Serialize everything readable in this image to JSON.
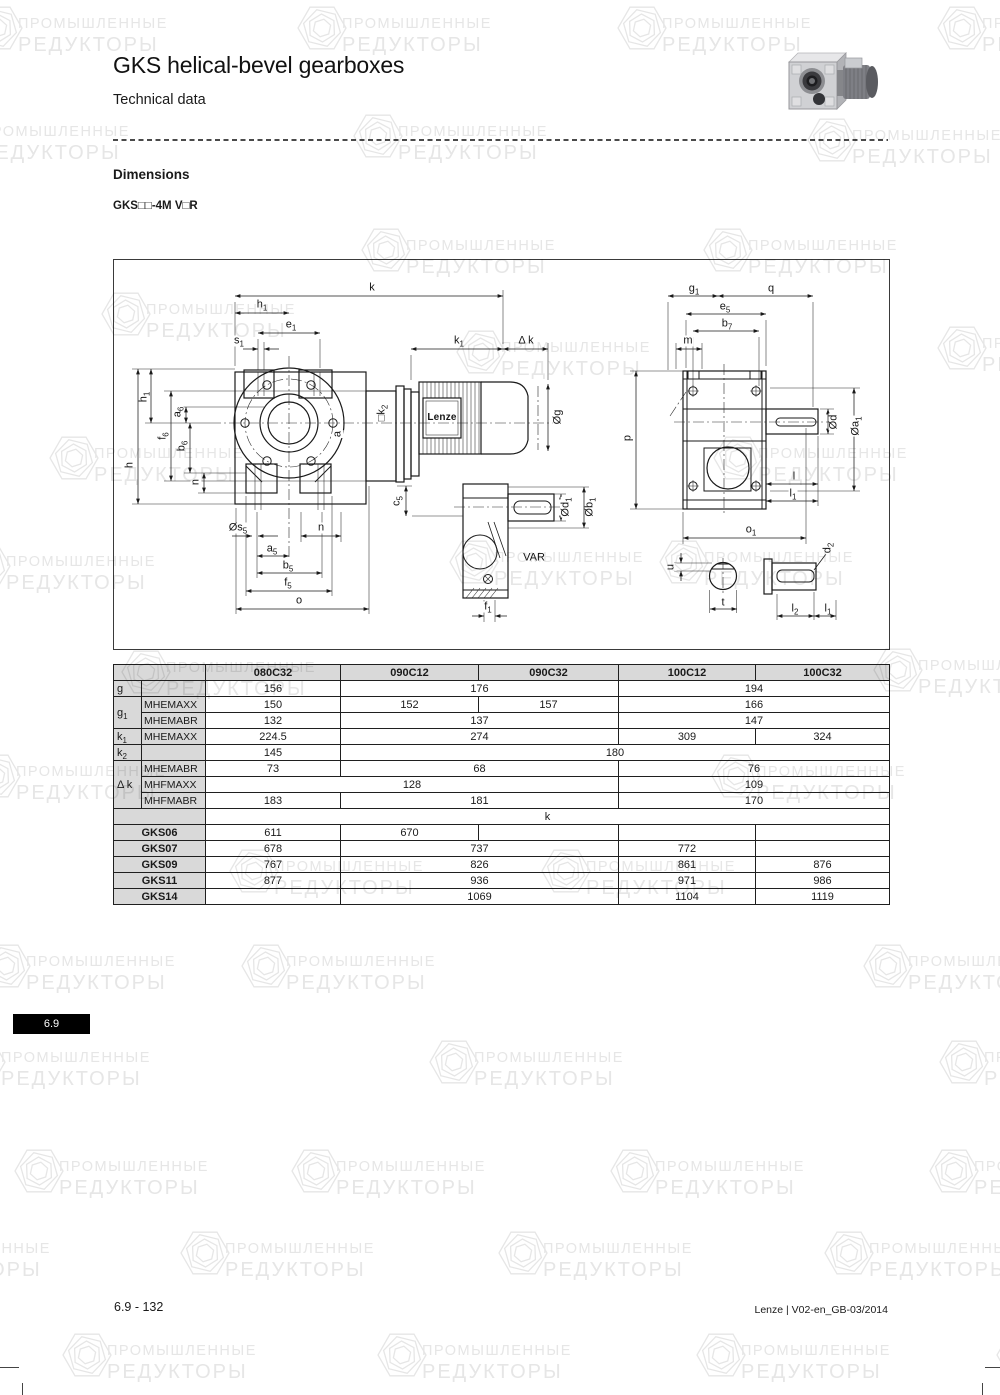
{
  "page": {
    "title": "GKS helical-bevel gearboxes",
    "subtitle": "Technical data",
    "section_heading": "Dimensions",
    "model_label": "GKS□□-4M V□R",
    "tab_label": "6.9",
    "footer_left": "6.9 - 132",
    "footer_right": "Lenze | V02-en_GB-03/2014"
  },
  "watermark": {
    "line1": "ПРОМЫШЛЕННЫЕ",
    "line2": "РЕДУКТОРЫ",
    "color": "#e6e6e6",
    "positions": [
      {
        "x": -28,
        "y": 0
      },
      {
        "x": 296,
        "y": 0
      },
      {
        "x": 616,
        "y": 0
      },
      {
        "x": 936,
        "y": 0
      },
      {
        "x": -66,
        "y": 108
      },
      {
        "x": 352,
        "y": 108
      },
      {
        "x": 806,
        "y": 112
      },
      {
        "x": 100,
        "y": 286
      },
      {
        "x": 360,
        "y": 222
      },
      {
        "x": 702,
        "y": 222
      },
      {
        "x": 455,
        "y": 324
      },
      {
        "x": 936,
        "y": 320
      },
      {
        "x": 48,
        "y": 430
      },
      {
        "x": 712,
        "y": 430
      },
      {
        "x": -40,
        "y": 538
      },
      {
        "x": 448,
        "y": 534
      },
      {
        "x": 658,
        "y": 534
      },
      {
        "x": 120,
        "y": 644
      },
      {
        "x": 872,
        "y": 642
      },
      {
        "x": -30,
        "y": 748
      },
      {
        "x": 710,
        "y": 748
      },
      {
        "x": 228,
        "y": 843
      },
      {
        "x": 540,
        "y": 843
      },
      {
        "x": -20,
        "y": 938
      },
      {
        "x": 240,
        "y": 938
      },
      {
        "x": 862,
        "y": 938
      },
      {
        "x": -45,
        "y": 1034
      },
      {
        "x": 428,
        "y": 1034
      },
      {
        "x": 938,
        "y": 1034
      },
      {
        "x": 13,
        "y": 1143
      },
      {
        "x": 290,
        "y": 1143
      },
      {
        "x": 609,
        "y": 1143
      },
      {
        "x": 928,
        "y": 1143
      },
      {
        "x": -145,
        "y": 1225
      },
      {
        "x": 179,
        "y": 1225
      },
      {
        "x": 497,
        "y": 1225
      },
      {
        "x": 823,
        "y": 1225
      },
      {
        "x": 61,
        "y": 1327
      },
      {
        "x": 376,
        "y": 1327
      },
      {
        "x": 695,
        "y": 1327
      },
      {
        "x": 995,
        "y": 1327
      }
    ]
  },
  "diagram": {
    "motor_brand": "Lenze",
    "variant_label": "VAR",
    "labels": [
      {
        "t": "k",
        "x": 258,
        "y": 28
      },
      {
        "t": "h_1",
        "x": 148,
        "y": 45
      },
      {
        "t": "e_1",
        "x": 177,
        "y": 65
      },
      {
        "t": "s_1",
        "x": 125,
        "y": 81
      },
      {
        "t": "k_1",
        "x": 345,
        "y": 81
      },
      {
        "t": "Δ k",
        "x": 412,
        "y": 81
      },
      {
        "t": "Øg",
        "x": 444,
        "y": 157,
        "r": 1
      },
      {
        "t": "h_1",
        "x": 30,
        "y": 137,
        "r": 1
      },
      {
        "t": "a_6",
        "x": 64,
        "y": 152,
        "r": 1
      },
      {
        "t": "f_6",
        "x": 49,
        "y": 176,
        "r": 1
      },
      {
        "t": "b_6",
        "x": 68,
        "y": 186,
        "r": 1
      },
      {
        "t": "h",
        "x": 16,
        "y": 205,
        "r": 1
      },
      {
        "t": "n",
        "x": 82,
        "y": 222,
        "r": 1
      },
      {
        "t": "a",
        "x": 224,
        "y": 174,
        "r": 1
      },
      {
        "t": "□k_2",
        "x": 268,
        "y": 153,
        "r": 1
      },
      {
        "t": "Øs_5",
        "x": 124,
        "y": 268
      },
      {
        "t": "n",
        "x": 207,
        "y": 268
      },
      {
        "t": "a_5",
        "x": 158,
        "y": 289
      },
      {
        "t": "b_5",
        "x": 174,
        "y": 306
      },
      {
        "t": "f_5",
        "x": 174,
        "y": 323
      },
      {
        "t": "o",
        "x": 185,
        "y": 341
      },
      {
        "t": "c_5",
        "x": 283,
        "y": 241,
        "r": 1
      },
      {
        "t": "Ød_1",
        "x": 452,
        "y": 247,
        "r": 1
      },
      {
        "t": "Øb_1",
        "x": 476,
        "y": 247,
        "r": 1
      },
      {
        "t": "VAR",
        "x": 420,
        "y": 298
      },
      {
        "t": "f_1",
        "x": 374,
        "y": 347
      },
      {
        "t": "Lenze",
        "x": 328,
        "y": 158,
        "cls": "lenze"
      },
      {
        "t": "g_1",
        "x": 580,
        "y": 29
      },
      {
        "t": "q",
        "x": 657,
        "y": 29
      },
      {
        "t": "e_5",
        "x": 611,
        "y": 47
      },
      {
        "t": "b_7",
        "x": 613,
        "y": 64
      },
      {
        "t": "m",
        "x": 574,
        "y": 81
      },
      {
        "t": "p",
        "x": 514,
        "y": 178,
        "r": 1
      },
      {
        "t": "Ød",
        "x": 720,
        "y": 162,
        "r": 1
      },
      {
        "t": "Øa_1",
        "x": 742,
        "y": 166,
        "r": 1
      },
      {
        "t": "l",
        "x": 680,
        "y": 217
      },
      {
        "t": "l_1",
        "x": 679,
        "y": 234
      },
      {
        "t": "o_1",
        "x": 637,
        "y": 270
      },
      {
        "t": "u",
        "x": 557,
        "y": 307,
        "r": 1
      },
      {
        "t": "t",
        "x": 609,
        "y": 343
      },
      {
        "t": "d_2",
        "x": 714,
        "y": 288,
        "r": 1
      },
      {
        "t": "l_2",
        "x": 681,
        "y": 349
      },
      {
        "t": "l_1",
        "x": 714,
        "y": 349
      }
    ]
  },
  "table": {
    "header": [
      {
        "t": "",
        "c": 2,
        "k": "h"
      },
      {
        "t": "080C32"
      },
      {
        "t": "090C12"
      },
      {
        "t": "090C32"
      },
      {
        "t": "100C12"
      },
      {
        "t": "100C32"
      }
    ],
    "rows": [
      [
        {
          "t": "g",
          "k": "L"
        },
        {
          "t": "",
          "k": "L2"
        },
        {
          "t": "156"
        },
        {
          "t": "176",
          "c": 2
        },
        {
          "t": "194",
          "c": 2
        }
      ],
      [
        {
          "t": "g_1",
          "k": "L",
          "r": 2
        },
        {
          "t": "MHEMAXX",
          "k": "L2"
        },
        {
          "t": "150"
        },
        {
          "t": "152"
        },
        {
          "t": "157"
        },
        {
          "t": "166",
          "c": 2
        }
      ],
      [
        {
          "t": "MHEMABR",
          "k": "L2"
        },
        {
          "t": "132"
        },
        {
          "t": "137",
          "c": 2
        },
        {
          "t": "147",
          "c": 2
        }
      ],
      [
        {
          "t": "k_1",
          "k": "L"
        },
        {
          "t": "MHEMAXX",
          "k": "L2"
        },
        {
          "t": "224.5"
        },
        {
          "t": "274",
          "c": 2
        },
        {
          "t": "309"
        },
        {
          "t": "324"
        }
      ],
      [
        {
          "t": "k_2",
          "k": "L"
        },
        {
          "t": "",
          "k": "L2"
        },
        {
          "t": "145"
        },
        {
          "t": "180",
          "c": 4
        }
      ],
      [
        {
          "t": "Δ k",
          "k": "L",
          "r": 3
        },
        {
          "t": "MHEMABR",
          "k": "L2"
        },
        {
          "t": "73"
        },
        {
          "t": "68",
          "c": 2
        },
        {
          "t": "76",
          "c": 2
        }
      ],
      [
        {
          "t": "MHFMAXX",
          "k": "L2"
        },
        {
          "t": "128",
          "c": 3
        },
        {
          "t": "109",
          "c": 2
        }
      ],
      [
        {
          "t": "MHFMABR",
          "k": "L2"
        },
        {
          "t": "183"
        },
        {
          "t": "181",
          "c": 2
        },
        {
          "t": "170",
          "c": 2
        }
      ],
      [
        {
          "t": "",
          "k": "L",
          "c": 2
        },
        {
          "t": "k",
          "c": 5
        }
      ],
      [
        {
          "t": "GKS06",
          "k": "G",
          "c": 2
        },
        {
          "t": "611"
        },
        {
          "t": "670"
        },
        {
          "t": ""
        },
        {
          "t": ""
        },
        {
          "t": ""
        }
      ],
      [
        {
          "t": "GKS07",
          "k": "G",
          "c": 2
        },
        {
          "t": "678"
        },
        {
          "t": "737",
          "c": 2
        },
        {
          "t": "772"
        },
        {
          "t": ""
        }
      ],
      [
        {
          "t": "GKS09",
          "k": "G",
          "c": 2
        },
        {
          "t": "767"
        },
        {
          "t": "826",
          "c": 2
        },
        {
          "t": "861"
        },
        {
          "t": "876"
        }
      ],
      [
        {
          "t": "GKS11",
          "k": "G",
          "c": 2
        },
        {
          "t": "877"
        },
        {
          "t": "936",
          "c": 2
        },
        {
          "t": "971"
        },
        {
          "t": "986"
        }
      ],
      [
        {
          "t": "GKS14",
          "k": "G",
          "c": 2
        },
        {
          "t": ""
        },
        {
          "t": "1069",
          "c": 2
        },
        {
          "t": "1104"
        },
        {
          "t": "1119"
        }
      ]
    ]
  }
}
